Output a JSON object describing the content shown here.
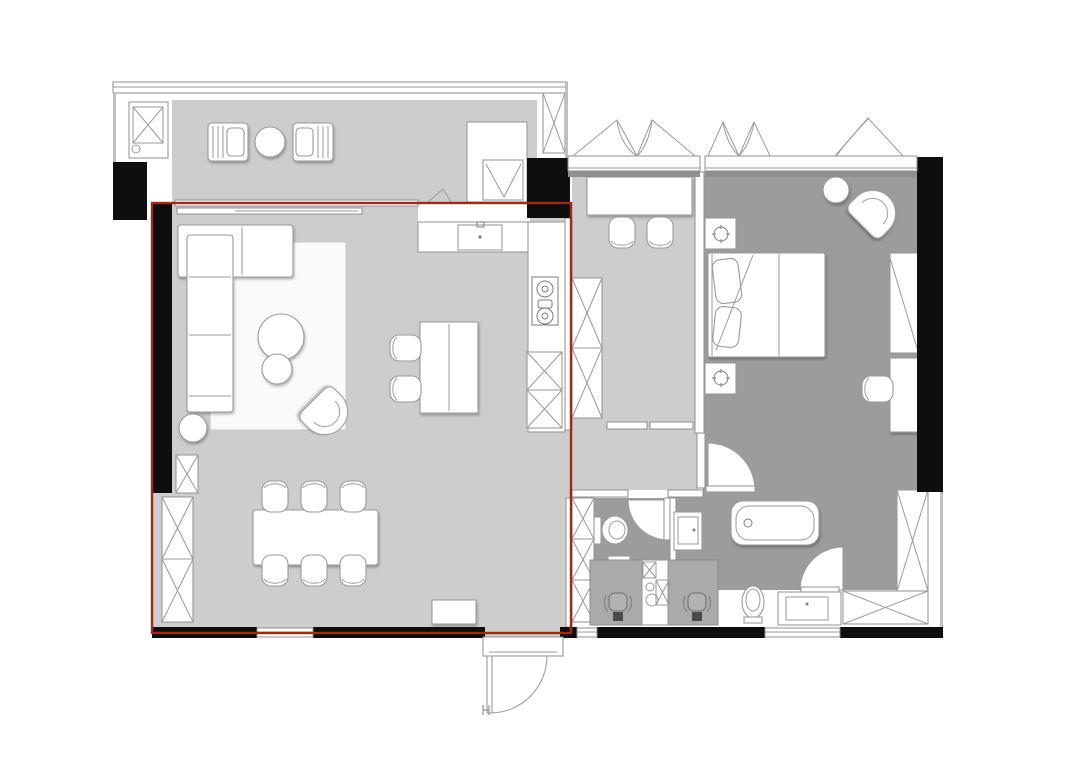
{
  "title": "apartment floor plan with living-dining-kitchen zone highlighted in red",
  "colors": {
    "canvas_bg": "#ffffff",
    "floor_light": "#cdcdcd",
    "floor_dark": "#9c9c9c",
    "floor_mid": "#aaaaaa",
    "wall_black": "#0e0e0e",
    "line_gray": "#9a9a9a",
    "wall_line": "#8f8f8f",
    "rug_white": "#fafafa",
    "highlight_red": "#9e2a1b"
  },
  "highlight": {
    "shape": "rectangle",
    "x": 152,
    "y": 203,
    "width": 419,
    "height": 430,
    "zone": "living-dining-open-kitchen"
  },
  "rooms": [
    {
      "name": "balcony",
      "floor": "light-gray",
      "items": [
        {
          "name": "washing-machine",
          "count": 1
        },
        {
          "name": "lounge-chair",
          "count": 2
        },
        {
          "name": "round-table",
          "count": 1
        },
        {
          "name": "tall-cabinet",
          "count": 2
        },
        {
          "name": "appliance-box",
          "count": 1
        }
      ]
    },
    {
      "name": "living-dining-kitchen",
      "floor": "light-gray",
      "highlighted": true,
      "items": [
        {
          "name": "corner-sofa",
          "count": 1
        },
        {
          "name": "rug",
          "count": 1
        },
        {
          "name": "coffee-table",
          "count": 2
        },
        {
          "name": "side-table",
          "count": 1
        },
        {
          "name": "tub-armchair",
          "count": 1
        },
        {
          "name": "dining-table",
          "count": 1
        },
        {
          "name": "dining-chair",
          "count": 6
        },
        {
          "name": "kitchen-counter-l",
          "count": 1
        },
        {
          "name": "kitchen-sink",
          "count": 1
        },
        {
          "name": "cooktop",
          "count": 1
        },
        {
          "name": "island-counter",
          "count": 1
        },
        {
          "name": "bar-stool",
          "count": 2
        },
        {
          "name": "storage-cabinet",
          "count": 3
        },
        {
          "name": "shoe-cabinet",
          "count": 1
        }
      ]
    },
    {
      "name": "study",
      "floor": "light-gray",
      "items": [
        {
          "name": "desk",
          "count": 1
        },
        {
          "name": "desk-chair",
          "count": 2
        },
        {
          "name": "wardrobe",
          "count": 1
        },
        {
          "name": "casement-window",
          "count": 1
        }
      ]
    },
    {
      "name": "hallway",
      "floor": "light-gray",
      "items": []
    },
    {
      "name": "master-bedroom",
      "floor": "dark-gray",
      "items": [
        {
          "name": "double-bed",
          "count": 1
        },
        {
          "name": "nightstand",
          "count": 2
        },
        {
          "name": "table-lamp",
          "count": 2
        },
        {
          "name": "tub-armchair",
          "count": 1
        },
        {
          "name": "side-table",
          "count": 1
        },
        {
          "name": "wardrobe",
          "count": 1
        },
        {
          "name": "desk",
          "count": 1
        },
        {
          "name": "desk-chair",
          "count": 1
        },
        {
          "name": "casement-window",
          "count": 1
        },
        {
          "name": "swing-door",
          "count": 1
        }
      ]
    },
    {
      "name": "bathroom-suite",
      "floor": "dark-gray",
      "items": [
        {
          "name": "toilet",
          "count": 2
        },
        {
          "name": "washbasin-cabinet",
          "count": 1
        },
        {
          "name": "bathtub",
          "count": 1
        },
        {
          "name": "vanity-sink",
          "count": 1
        },
        {
          "name": "dressing-table",
          "count": 2
        },
        {
          "name": "dressing-chair",
          "count": 2
        },
        {
          "name": "laundry-utility-unit",
          "count": 1
        },
        {
          "name": "l-shaped-wardrobe",
          "count": 1
        },
        {
          "name": "tall-cabinet",
          "count": 1
        },
        {
          "name": "swing-door",
          "count": 3
        }
      ]
    },
    {
      "name": "entrance",
      "floor": "none",
      "items": [
        {
          "name": "entry-door",
          "count": 1
        }
      ]
    }
  ]
}
